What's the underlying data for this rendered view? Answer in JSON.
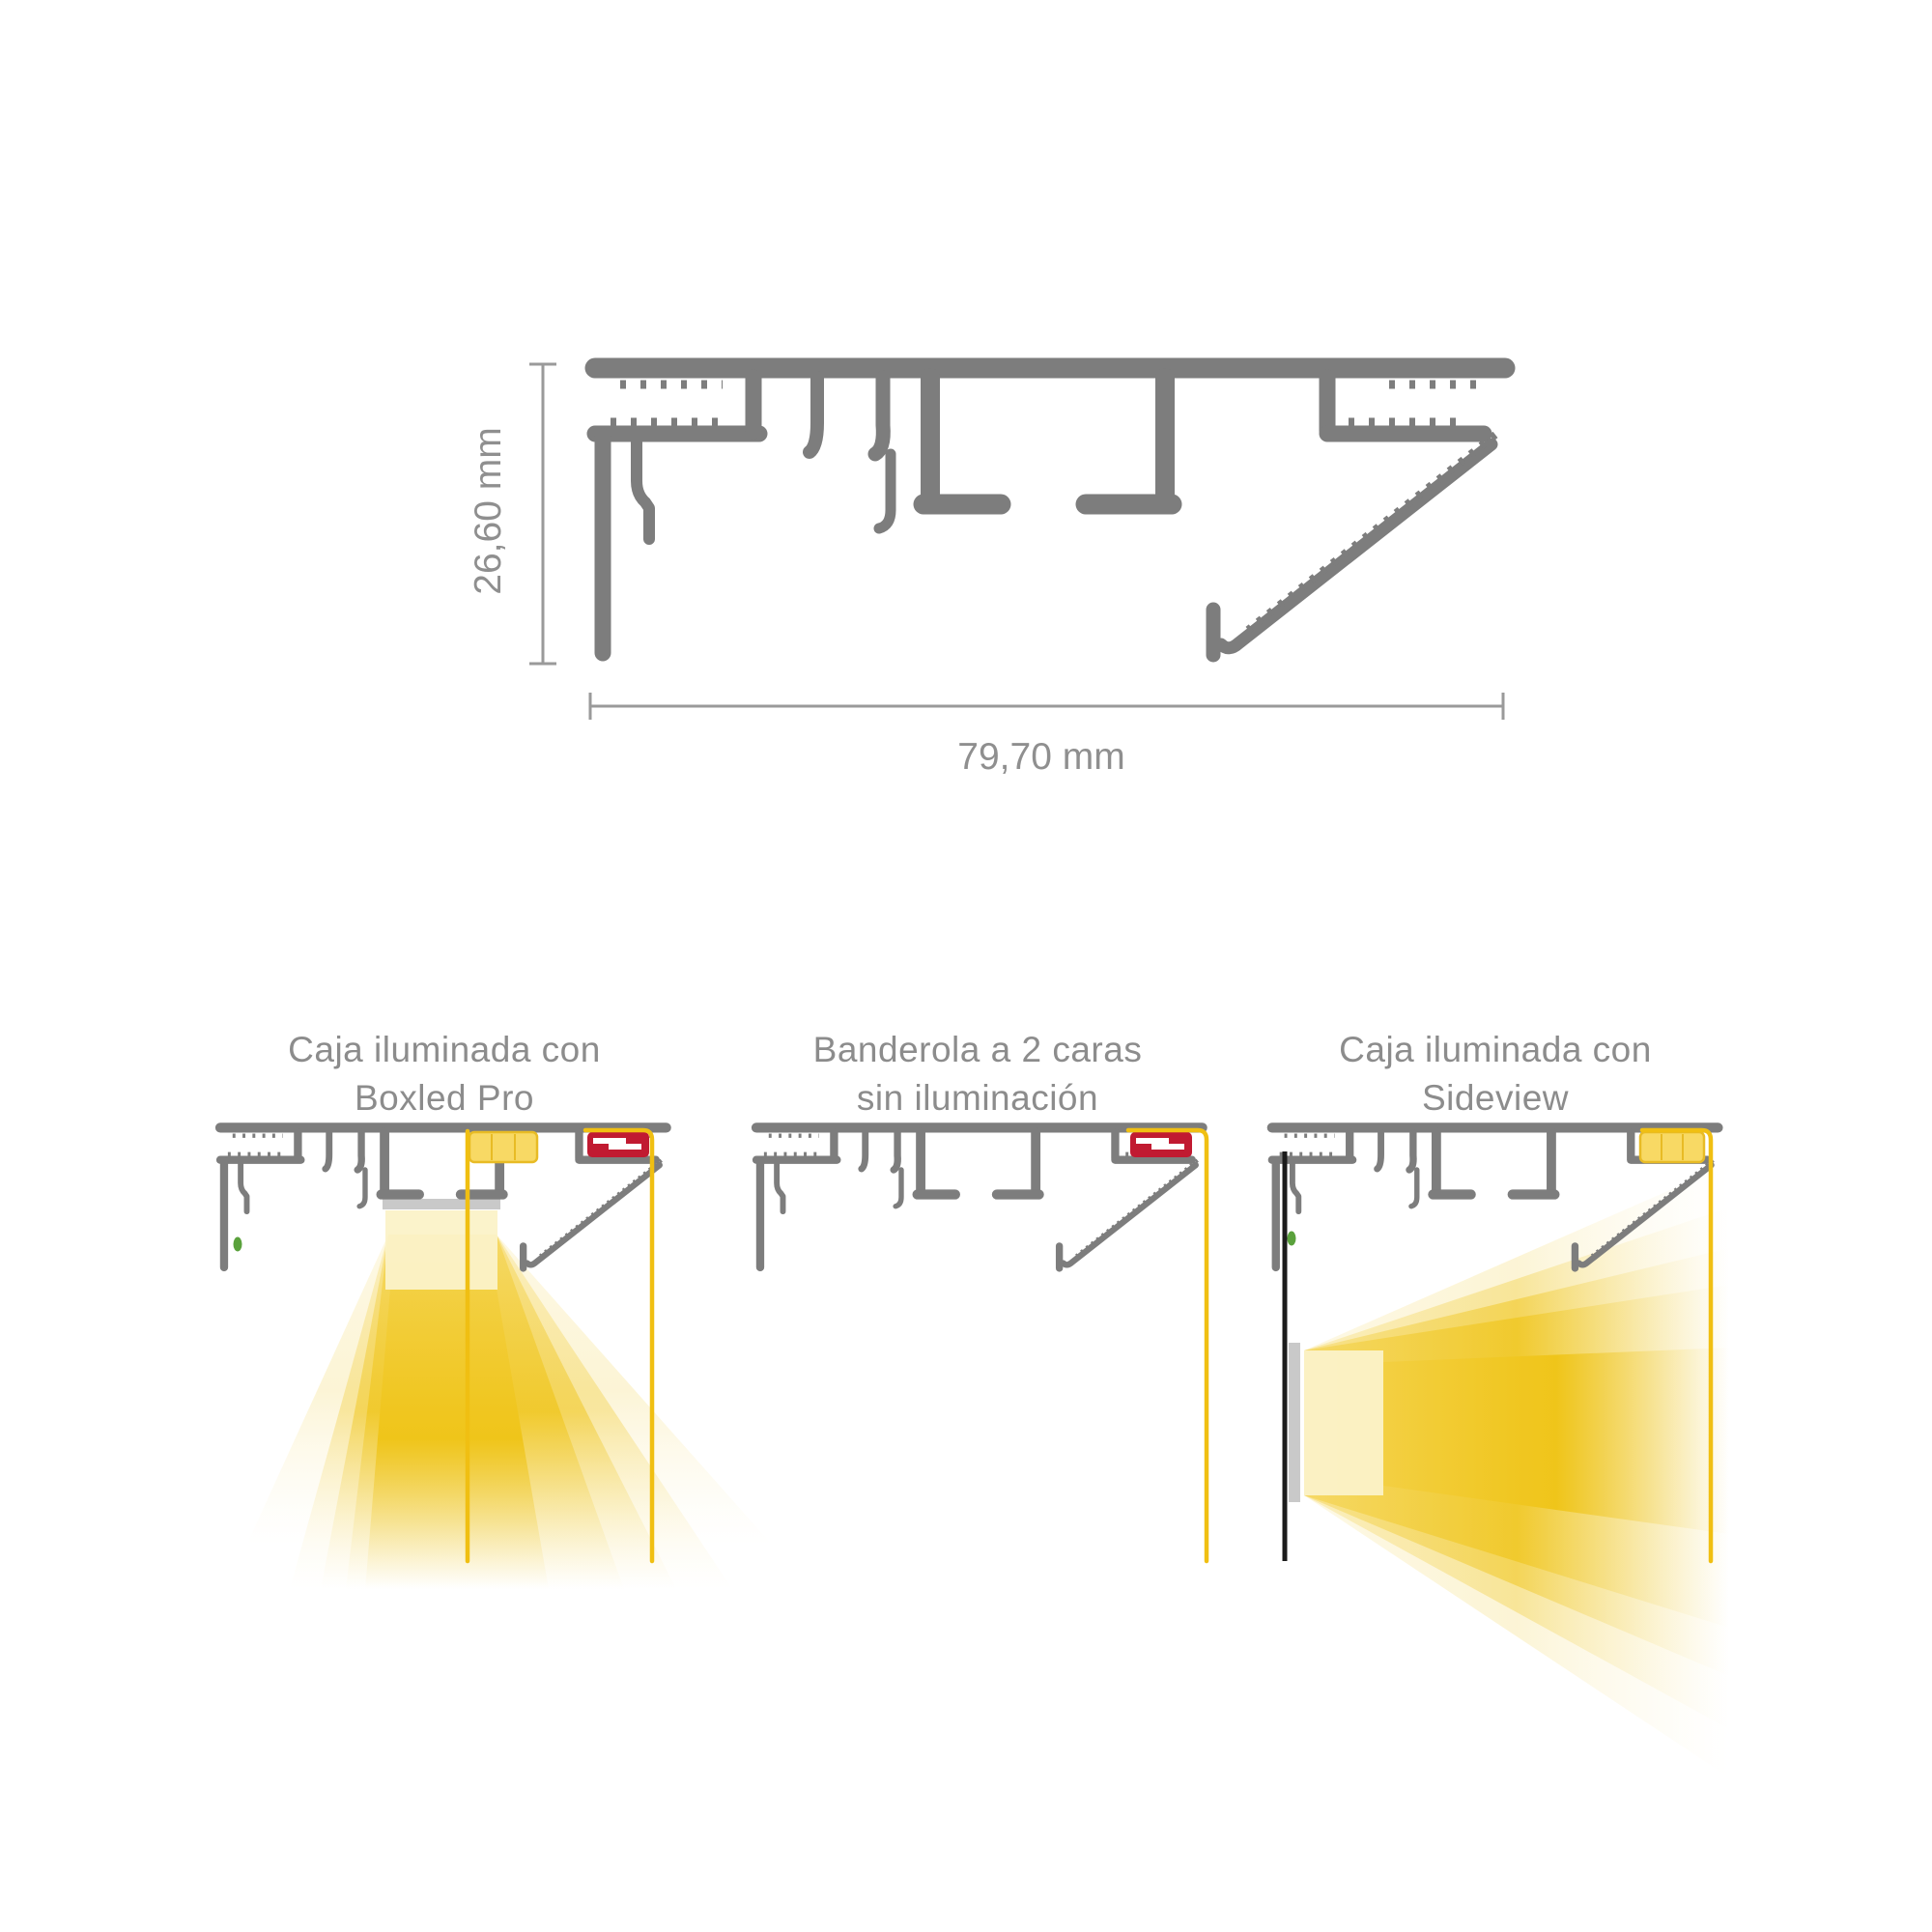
{
  "illustration": {
    "subject": "aluminium-signage-profile-cross-section",
    "dimensions": {
      "height_label": "26,60 mm",
      "width_label": "79,70 mm"
    },
    "diagrams": [
      {
        "id": "boxled",
        "caption_line1": "Caja iluminada con",
        "caption_line2": "Boxled Pro"
      },
      {
        "id": "banderola",
        "caption_line1": "Banderola a 2 caras",
        "caption_line2": "sin iluminación"
      },
      {
        "id": "sideview",
        "caption_line1": "Caja iluminada con",
        "caption_line2": "Sideview"
      }
    ]
  },
  "colors": {
    "profile_gray": "#7d7d7d",
    "dimension_gray": "#9a9a9a",
    "text_gray": "#8c8c8c",
    "accent_yellow": "#f0bf12",
    "panel_yellow_fill": "#f8d964",
    "panel_yellow_stroke": "#e8bb25",
    "led_red": "#c11a31",
    "indicator_green": "#5aa13c",
    "beam_gold": "#efc417",
    "beam_pale": "#fbf2c8",
    "diffuser_gray": "#c9c9c9",
    "banner_black": "#1c1c1c"
  }
}
